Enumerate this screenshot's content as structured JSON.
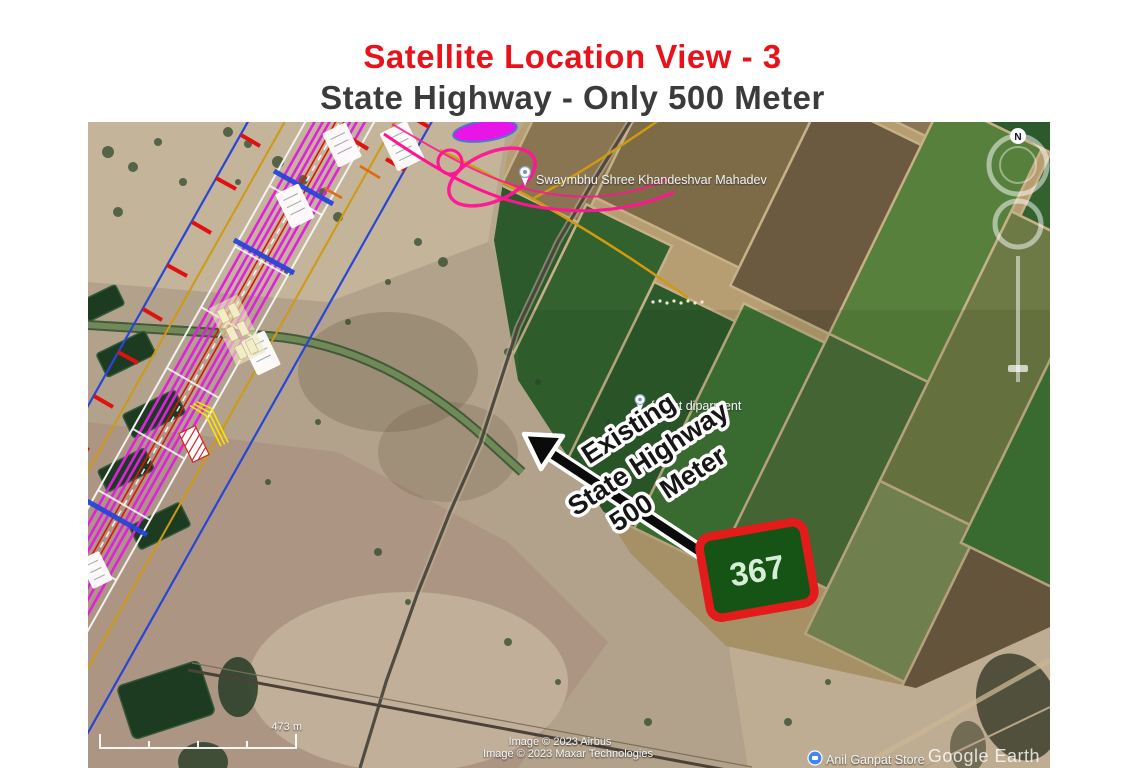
{
  "title": {
    "line1": "Satellite Location View - 3",
    "line2": "State Highway - Only 500 Meter"
  },
  "map": {
    "place_labels": {
      "temple": "Swaymbhu Shree Khandeshvar Mahadev",
      "forest": "forest diparment",
      "store": "Anil Ganpat Store"
    },
    "annotation": {
      "line1": "Existing",
      "line2": "State Highway",
      "line3": "500  Meter"
    },
    "plot": {
      "number": "367"
    },
    "compass_north": "N",
    "scale_label": "473 m",
    "attribution": {
      "line1": "Image © 2023 Airbus",
      "line2": "Image © 2023 Maxar Technologies"
    },
    "watermark": "Google Earth"
  },
  "colors": {
    "title_red": "#e9111a",
    "subtitle_gray": "#3b3b3b",
    "plot_green": "#155415",
    "plot_border_red": "#e31b1b",
    "overlay_magenta": "#e020e0",
    "overlay_pink": "#ff1493",
    "overlay_blue": "#2746d8",
    "overlay_gold": "#cf9a10",
    "arrow_black": "#0b0b0b"
  }
}
